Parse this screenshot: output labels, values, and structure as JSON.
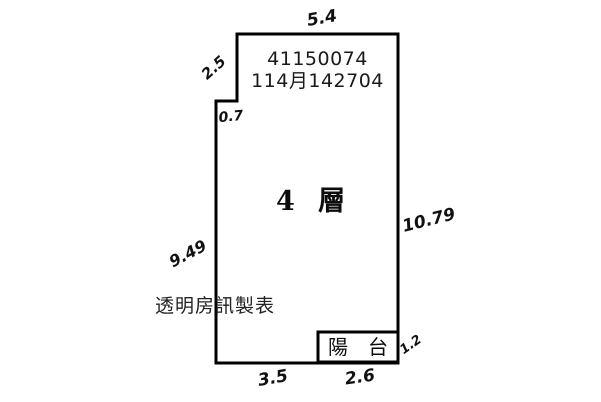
{
  "plan": {
    "unit_number": "41150074",
    "registry_code": "114月142704",
    "floor_label": "4 層",
    "balcony_label": "陽　台",
    "watermark": "透明房訊製表",
    "dimensions": {
      "top": "5.4",
      "upper_left": "2.5",
      "notch": "0.7",
      "right": "10.79",
      "left": "9.49",
      "balcony_right": "1.2",
      "bottom_left": "3.5",
      "bottom_right": "2.6"
    },
    "colors": {
      "line": "#000000",
      "background": "#ffffff",
      "text": "#1a1a1a"
    }
  }
}
